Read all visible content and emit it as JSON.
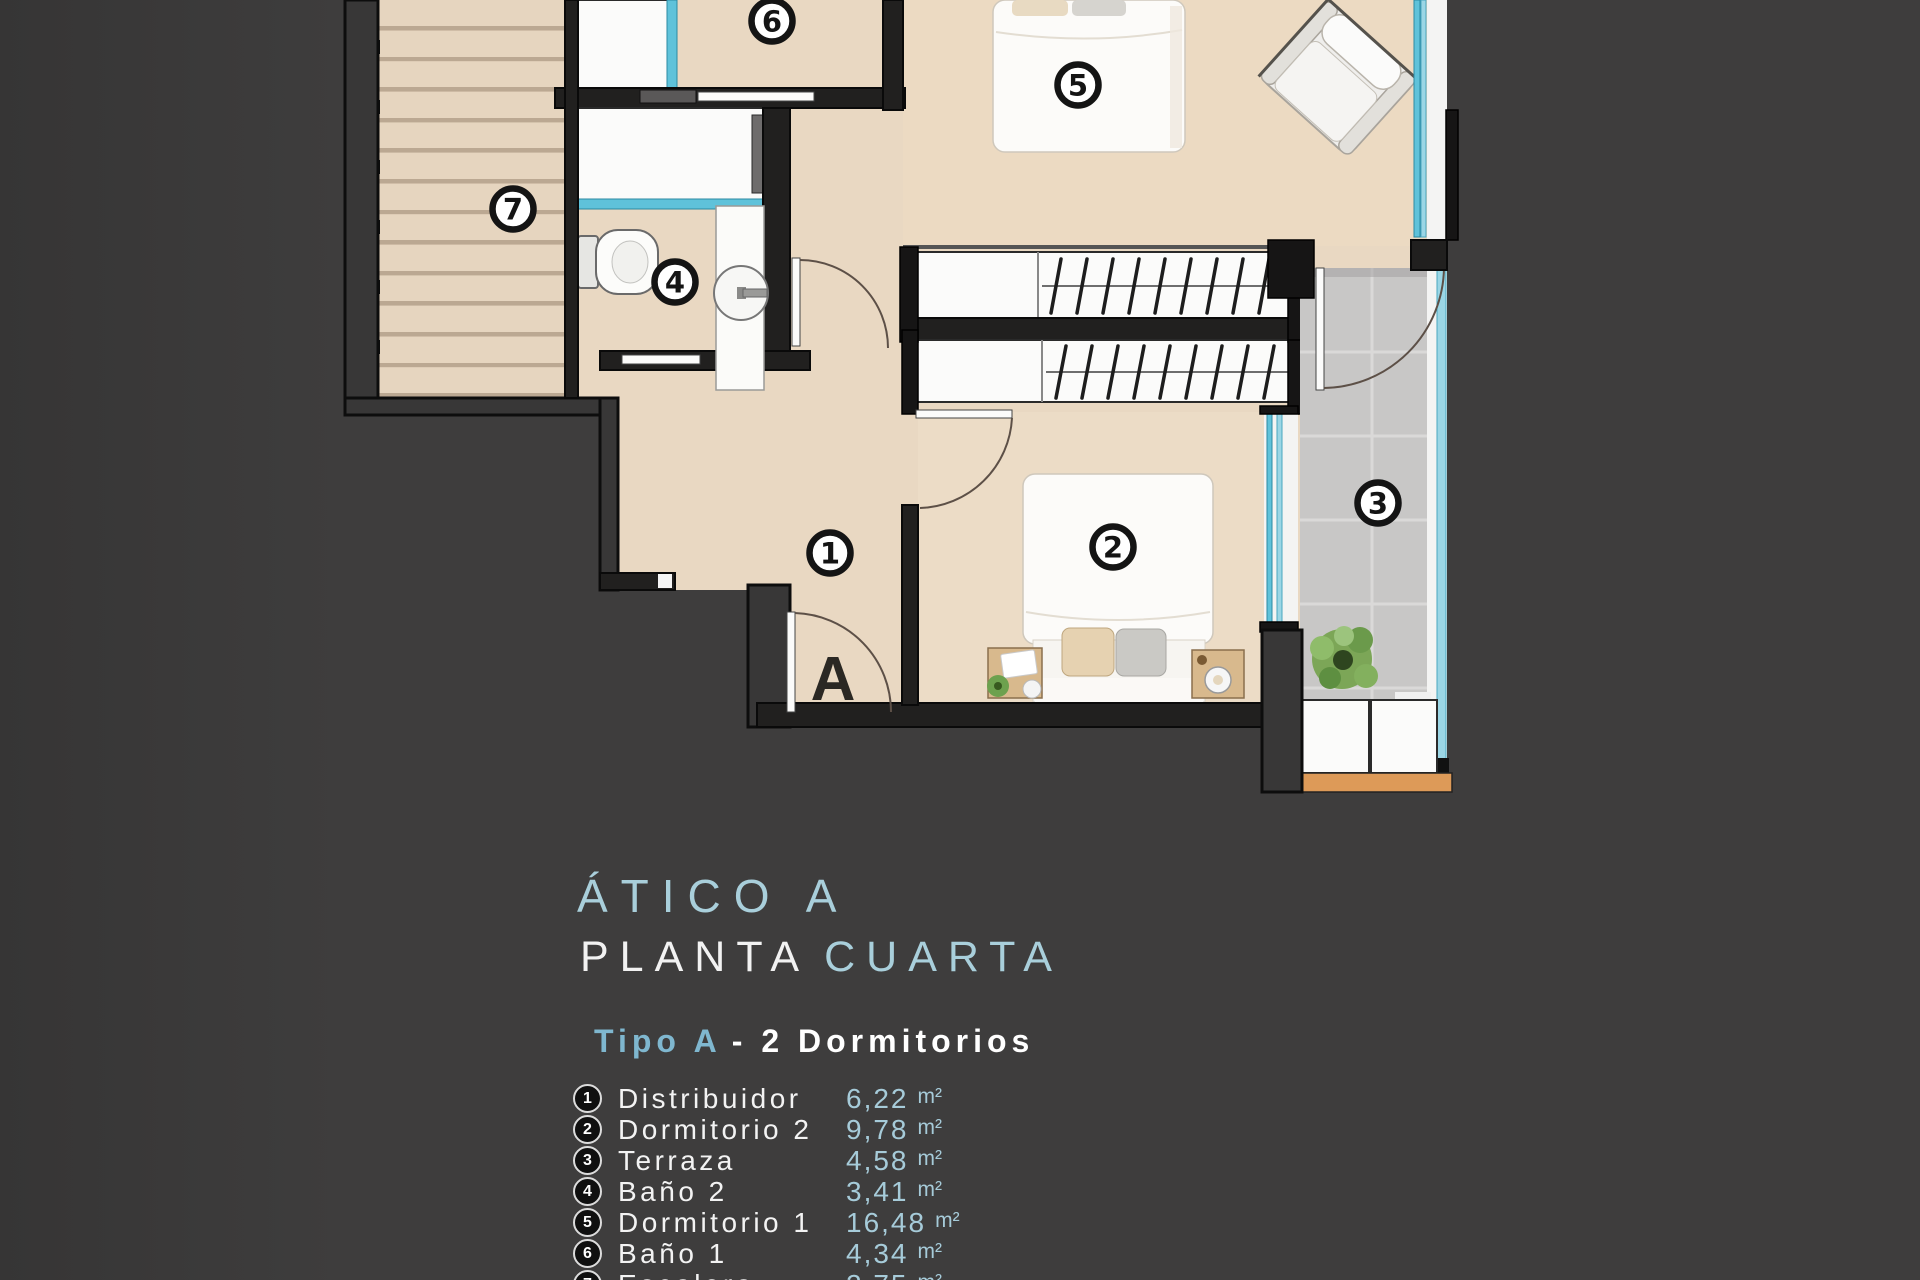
{
  "colors": {
    "background": "#3e3d3d",
    "floor_beige": "#e9d8c2",
    "glass_blue": "#5fc2da",
    "terrace_grey": "#c8c7c6",
    "title_blue": "#a9cfdb",
    "subtitle_blue": "#7fb7cf",
    "value_blue": "#a6cbd9",
    "wood_orange": "#dd9a58"
  },
  "plan": {
    "labels": [
      {
        "text": "1",
        "x": 830,
        "y": 553
      },
      {
        "text": "2",
        "x": 1113,
        "y": 547
      },
      {
        "text": "3",
        "x": 1378,
        "y": 503
      },
      {
        "text": "4",
        "x": 675,
        "y": 282
      },
      {
        "text": "5",
        "x": 1078,
        "y": 85
      },
      {
        "text": "6",
        "x": 772,
        "y": 21
      },
      {
        "text": "7",
        "x": 513,
        "y": 209
      }
    ],
    "entry_label": {
      "text": "A",
      "x": 833,
      "y": 700
    }
  },
  "titles": {
    "line1": "ÁTICO A",
    "line2_white": "PLANTA",
    "line2_blue": "CUARTA",
    "subtitle_blue": "Tipo A",
    "subtitle_white": "- 2 Dormitorios"
  },
  "legend": {
    "items": [
      {
        "number": "1",
        "name": "Distribuidor",
        "area": "6,22",
        "unit": "m²"
      },
      {
        "number": "2",
        "name": "Dormitorio 2",
        "area": "9,78",
        "unit": "m²"
      },
      {
        "number": "3",
        "name": "Terraza",
        "area": "4,58",
        "unit": "m²"
      },
      {
        "number": "4",
        "name": "Baño 2",
        "area": "3,41",
        "unit": "m²"
      },
      {
        "number": "5",
        "name": "Dormitorio 1",
        "area": "16,48",
        "unit": "m²"
      },
      {
        "number": "6",
        "name": "Baño 1",
        "area": "4,34",
        "unit": "m²"
      },
      {
        "number": "7",
        "name": "Escalera",
        "area": "2,75",
        "unit": "m²"
      }
    ]
  }
}
